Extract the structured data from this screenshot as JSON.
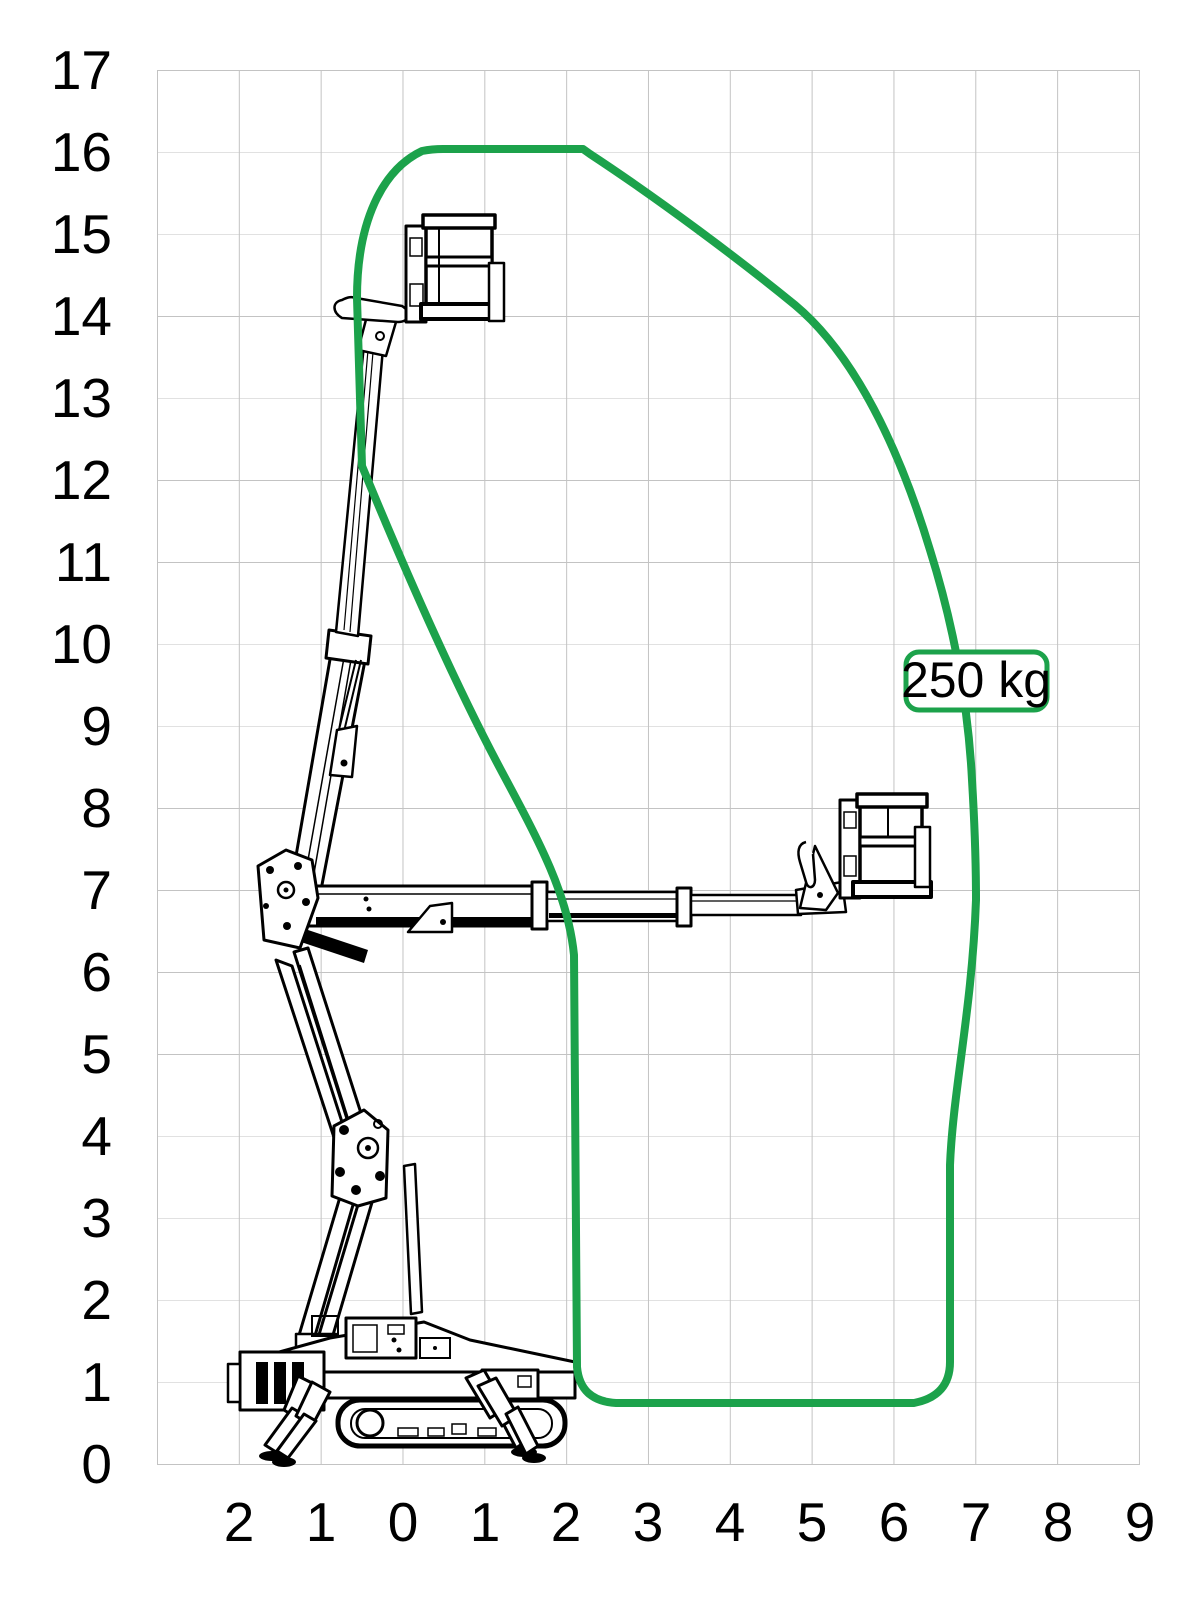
{
  "chart_data": {
    "type": "area",
    "title": "",
    "description": "Working envelope (outreach/height) diagram of a tracked spider boom lift drawn in two boom positions",
    "load_label": "250 kg",
    "x_axis": {
      "ticks": [
        "2",
        "1",
        "0",
        "1",
        "2",
        "3",
        "4",
        "5",
        "6",
        "7",
        "8",
        "9"
      ],
      "range_m": [
        -3,
        9
      ],
      "gridline_spacing_m": 1
    },
    "y_axis": {
      "ticks": [
        "17",
        "16",
        "15",
        "14",
        "13",
        "12",
        "11",
        "10",
        "9",
        "8",
        "7",
        "6",
        "5",
        "4",
        "3",
        "2",
        "1",
        "0"
      ],
      "range_m": [
        0,
        17
      ],
      "gridline_spacing_m": 1
    },
    "envelope": {
      "max_height_m": 16,
      "max_outreach_m": 7,
      "outline_m": [
        [
          0.5,
          16
        ],
        [
          2.2,
          16
        ],
        [
          4.8,
          13.9
        ],
        [
          6.5,
          11.0
        ],
        [
          7.0,
          8.2
        ],
        [
          7.0,
          6.9
        ],
        [
          6.7,
          3.7
        ],
        [
          6.7,
          1.2
        ],
        [
          6.3,
          0.75
        ],
        [
          2.6,
          0.75
        ],
        [
          2.1,
          1.2
        ],
        [
          2.1,
          6.2
        ],
        [
          1.0,
          9.6
        ],
        [
          -0.5,
          12.2
        ],
        [
          -0.55,
          14.2
        ]
      ]
    },
    "envelope_path": "M 443,149 L 583,149 L 590,154 C 660,200 740,260 795,305 C 855,355 900,450 930,550 C 952,620 968,700 972,780 C 975,830 976,860 976,900 C 972,1010 953,1090 950,1165 L 950,1362 Q 950,1396 914,1403 L 616,1403 Q 580,1401 577,1367 L 574,955 C 568,895 540,843 502,772 C 457,688 407,575 362,466 L 357,298 C 357,222 382,170 422,151 Q 432,149 443,149 Z",
    "grid": true,
    "legend": "none",
    "colors": {
      "envelope": "#1CA24B",
      "grid": "#c3c3c3",
      "text": "#000000",
      "machine_line": "#000000"
    }
  }
}
